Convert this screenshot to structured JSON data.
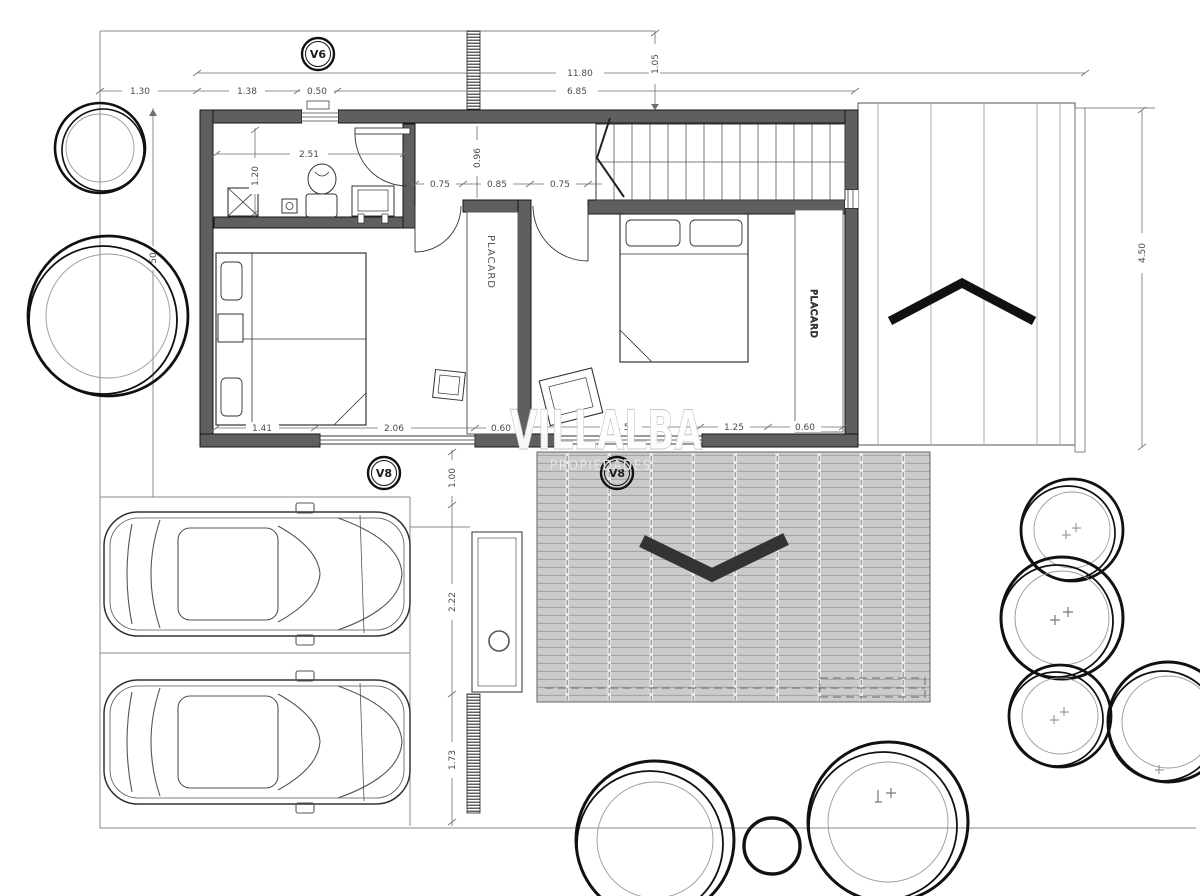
{
  "window_tags": {
    "v6": "V6",
    "v8_left": "V8",
    "v8_right": "V8"
  },
  "closets": {
    "left": "PLACARD",
    "right": "PLACARD"
  },
  "watermark": {
    "brand": "VILLALBA",
    "tagline": "PROPIEDADES"
  },
  "dims": {
    "top_overall": "11.80",
    "top_inner": "6.85",
    "top_offset": "1.05",
    "top_left_a": "1.30",
    "top_left_b": "1.38",
    "top_left_c": "0.50",
    "bath_w": "2.51",
    "bath_d": "1.20",
    "hall_a": "0.75",
    "hall_b": "0.85",
    "hall_c": "0.75",
    "hall_d": "0.96",
    "b1_a": "1.41",
    "b1_b": "2.06",
    "b1_c": "0.60",
    "b2_a": "2. 5",
    "b2_b": "1.25",
    "b2_c": "0.60",
    "yard_a": "1.00",
    "yard_b": "2.22",
    "yard_c": "1.73",
    "right_h": "4.50",
    "site_l": "50"
  },
  "colors": {
    "wall": "#5f5f5f",
    "wall_edge": "#161616",
    "deck": "#cbcbcb",
    "dim_text": "#4a4a4a",
    "watermark": "#ffffff"
  }
}
